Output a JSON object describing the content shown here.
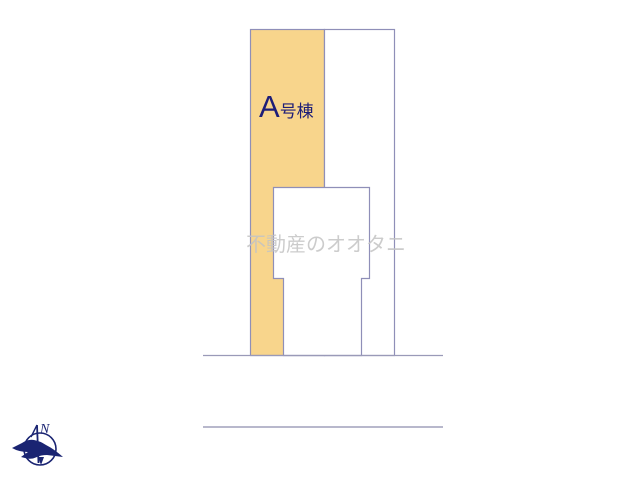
{
  "diagram": {
    "kind": "real-estate site plan",
    "unit_label": {
      "letter": "A",
      "suffix": "号棟"
    },
    "watermark_text": "不動産のオオタニ",
    "compass": {
      "north_label": "N"
    }
  },
  "colors": {
    "background": "#ffffff",
    "unit_parcel_fill": "#f8d58c",
    "neighbor_parcel_fill": "#ffffff",
    "building_fill": "#ffffff",
    "outline": "#8f8fb8",
    "road_line_near": "#9a9ab8",
    "road_line_far": "#b8b8cc",
    "unit_label_text": "#1e1e78",
    "watermark_text_color": "#c4c4c4",
    "compass_color": "#1a2472"
  }
}
